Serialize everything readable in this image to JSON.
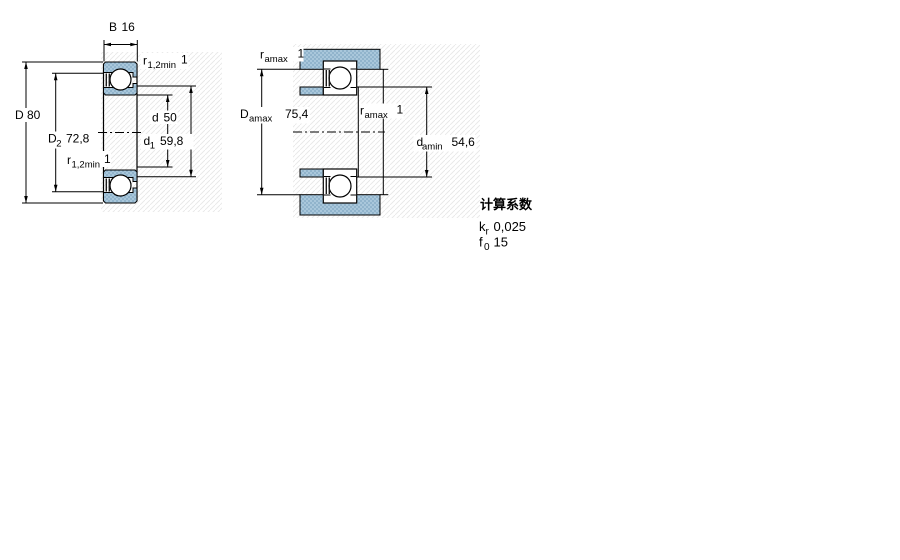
{
  "colors": {
    "steel_blue_fill": "#A9C7DB",
    "steel_blue_dot": "#7FA6C2",
    "hatch_line": "#E7E7E7",
    "outline": "#000000",
    "shield_dark": "#1a1a1a"
  },
  "left_diagram": {
    "dims": {
      "B": {
        "label": "B",
        "sub": "",
        "value": "16"
      },
      "r_top": {
        "label": "r",
        "sub": "1,2min",
        "value": "1"
      },
      "D": {
        "label": "D",
        "sub": "",
        "value": "80"
      },
      "D2": {
        "label": "D",
        "sub": "2",
        "value": "72,8"
      },
      "r_bot": {
        "label": "r",
        "sub": "1,2min",
        "value": "1"
      },
      "d": {
        "label": "d",
        "sub": "",
        "value": "50"
      },
      "d1": {
        "label": "d",
        "sub": "1",
        "value": "59,8"
      }
    }
  },
  "right_diagram": {
    "dims": {
      "r_top": {
        "label": "r",
        "sub": "amax",
        "value": "1"
      },
      "Damax": {
        "label": "D",
        "sub": "amax",
        "value": "75,4"
      },
      "r_mid": {
        "label": "r",
        "sub": "amax",
        "value": "1"
      },
      "damin": {
        "label": "d",
        "sub": "amin",
        "value": "54,6"
      }
    }
  },
  "factors": {
    "title": "计算系数",
    "kr": {
      "label": "k",
      "sub": "r",
      "value": "0,025"
    },
    "f0": {
      "label": "f",
      "sub": "0",
      "value": "15"
    }
  }
}
